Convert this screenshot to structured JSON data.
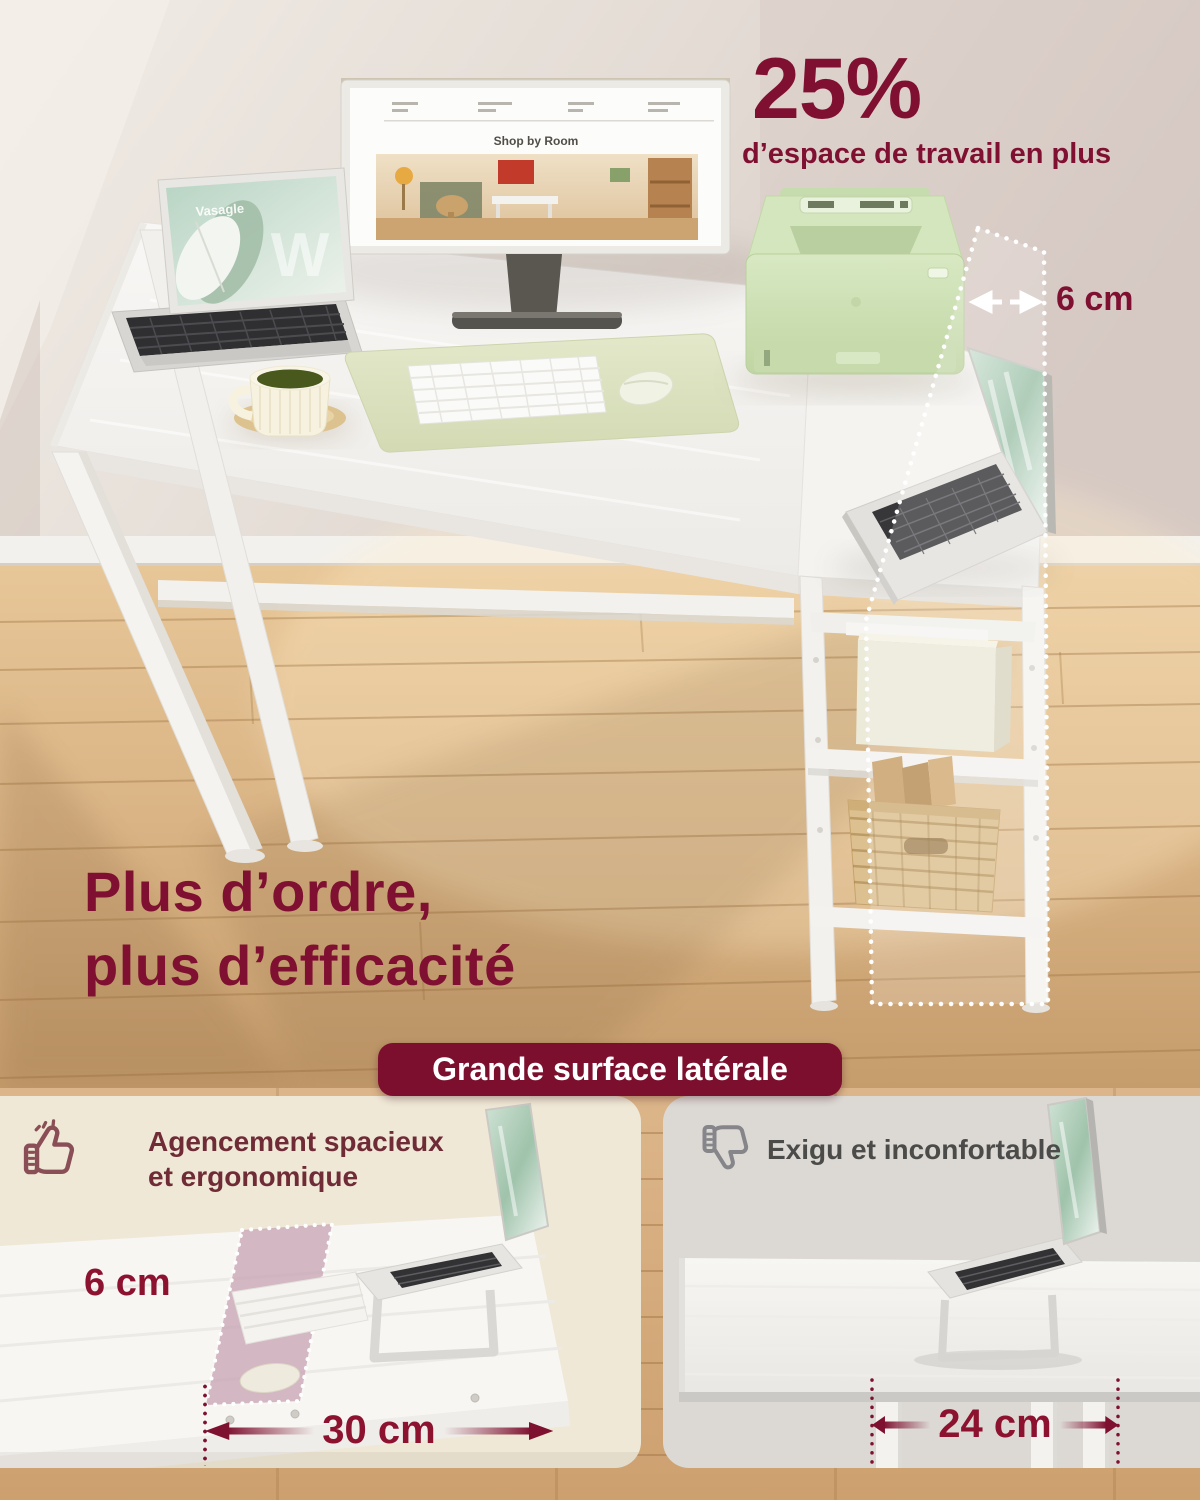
{
  "colors": {
    "accent": "#7F1031",
    "banner_bg": "#7C0F2E",
    "measure_text": "#8C1230",
    "left_panel_bg": "#EFE8D6",
    "right_panel_bg": "#DCD8D3",
    "left_panel_text": "#6F2B36",
    "right_panel_text": "#4B4B49",
    "wood_floor": "#D8B181",
    "desk_white": "#F6F5F3",
    "printer_mint": "#CFE2B8",
    "desk_mat_sage": "#DDE3C5",
    "highlight_strip_pink": "#C9A8B6"
  },
  "scene": {
    "headline_percent": "25%",
    "headline_caption": "d’espace de travail en plus",
    "extension_width_label": "6 cm",
    "tagline_line1": "Plus d’ordre,",
    "tagline_line2": "plus d’efficacité",
    "monitor_heading": "Shop by Room",
    "tablet_brand": "Vasagle",
    "tablet_watermark": "W"
  },
  "banner": {
    "label": "Grande surface latérale"
  },
  "comparison": {
    "left": {
      "icon": "thumbs-up-icon",
      "label": "Agencement spacieux et ergonomique",
      "depth_label": "6 cm",
      "width_label": "30 cm"
    },
    "right": {
      "icon": "thumbs-down-icon",
      "label": "Exigu et inconfortable",
      "width_label": "24 cm"
    }
  }
}
